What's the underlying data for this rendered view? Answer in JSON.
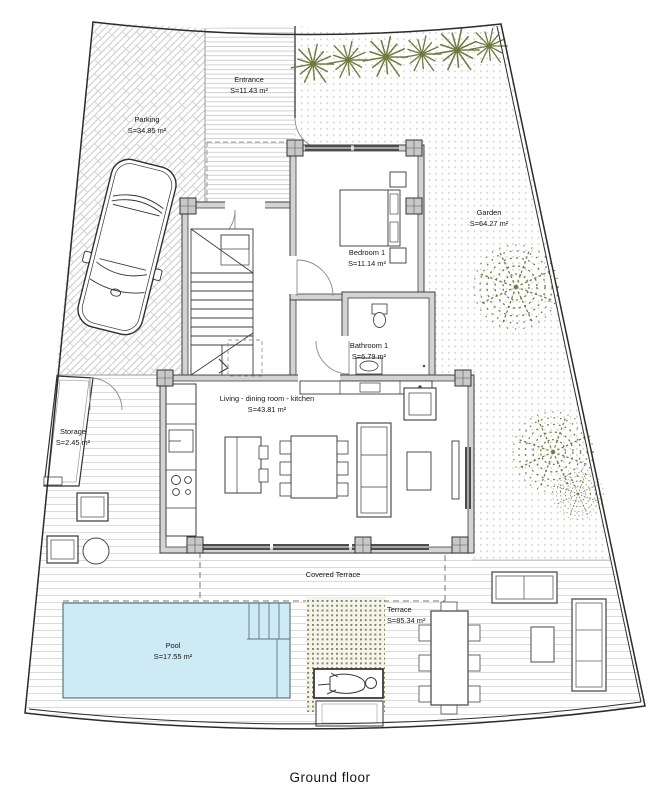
{
  "plan": {
    "caption": "Ground floor",
    "rooms": {
      "parking": {
        "name": "Parking",
        "area": "S=34.85 m²"
      },
      "entrance": {
        "name": "Entrance",
        "area": "S=11.43 m²"
      },
      "garden": {
        "name": "Garden",
        "area": "S=64.27 m²"
      },
      "bedroom1": {
        "name": "Bedroom 1",
        "area": "S=11.14 m²"
      },
      "bathroom1": {
        "name": "Bathroom 1",
        "area": "S=6.79 m²"
      },
      "living": {
        "name": "Living - dining  room - kitchen",
        "area": "S=43.81 m²"
      },
      "storage": {
        "name": "Storage",
        "area": "S=2.45 m²"
      },
      "covered_terrace": {
        "name": "Covered Terrace"
      },
      "pool": {
        "name": "Pool",
        "area": "S=17.55 m²"
      },
      "terrace": {
        "name": "Terrace",
        "area": "S=85.34 m²"
      }
    },
    "colors": {
      "pool_fill": "#cdeaf5",
      "plant_green": "#6f7b41",
      "wall_gray": "#d3d3d3",
      "caption_gray": "#85898c"
    }
  }
}
